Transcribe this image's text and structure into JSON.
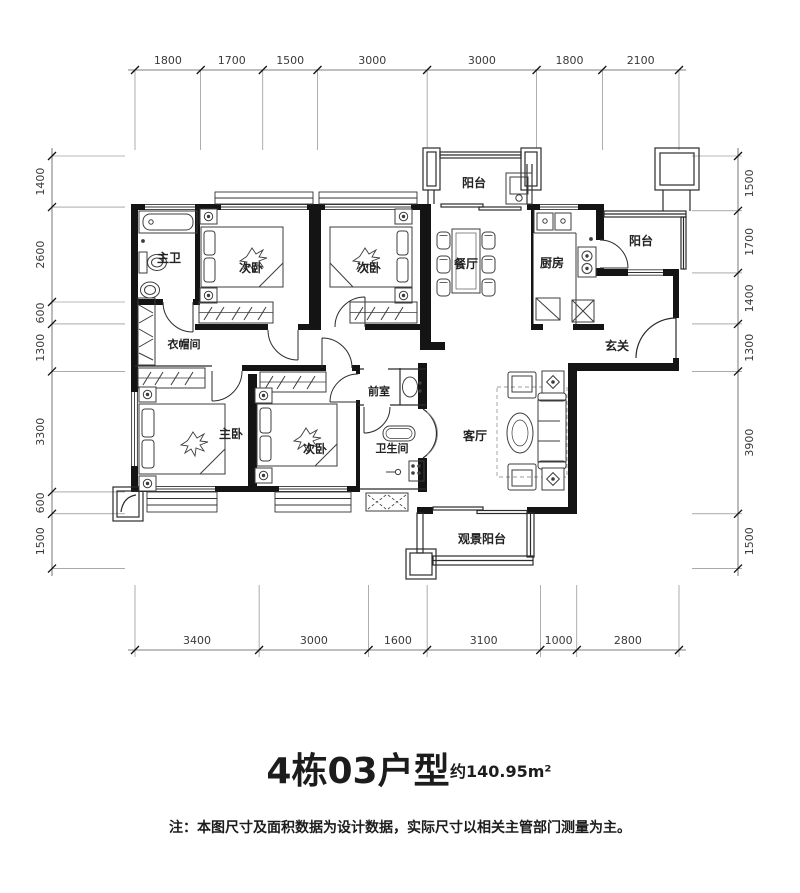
{
  "title": {
    "main": "4栋03户型",
    "area": "约140.95m²"
  },
  "note": "注：本图尺寸及面积数据为设计数据，实际尺寸以相关主管部门测量为主。",
  "dimensions": {
    "top": [
      "1800",
      "1700",
      "1500",
      "3000",
      "3000",
      "1800",
      "2100"
    ],
    "bottom": [
      "3400",
      "3000",
      "1600",
      "3100",
      "1000",
      "2800"
    ],
    "left": [
      "1400",
      "2600",
      "600",
      "1300",
      "3300",
      "600",
      "1500"
    ],
    "right": [
      "1500",
      "1700",
      "1400",
      "1300",
      "3900",
      "1500"
    ]
  },
  "rooms": {
    "master_bath": "主卫",
    "bedroom_top_left": "次卧",
    "bedroom_top_mid": "次卧",
    "balcony_top": "阳台",
    "dining": "餐厅",
    "kitchen": "厨房",
    "balcony_right": "阳台",
    "foyer": "玄关",
    "cloakroom": "衣帽间",
    "master_bedroom": "主卧",
    "bedroom_bottom": "次卧",
    "anteroom": "前室",
    "bathroom": "卫生间",
    "living": "客厅",
    "view_balcony": "观景阳台"
  }
}
